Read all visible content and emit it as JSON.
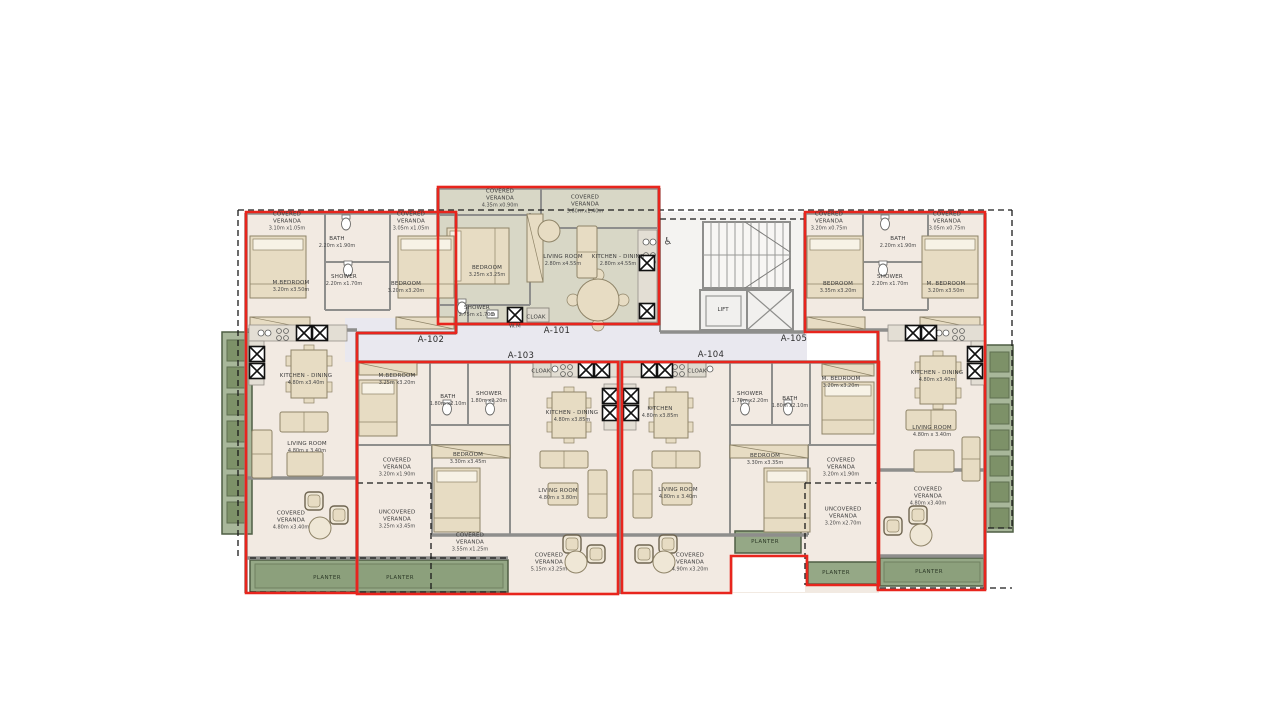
{
  "plan_title": "Typical floor plan — apartments A-101 to A-105",
  "colors": {
    "unit_outline_red": "#E8251D",
    "floor_beige": "#F2EAE2",
    "floor_a101": "#D8D7C6",
    "corridor": "#E9E8EF",
    "core_floor": "#F4F3F1",
    "wall_gray": "#8E8E8C",
    "planter_green": "#95A886",
    "planter_dark": "#7D9168",
    "planter_border": "#4F5E44",
    "furniture_tan": "#E7DCC3",
    "furniture_line": "#8F8468",
    "dash_black": "#1A1A1A"
  },
  "units": [
    {
      "id": "A-101",
      "x": 557,
      "y": 331
    },
    {
      "id": "A-102",
      "x": 431,
      "y": 340
    },
    {
      "id": "A-103",
      "x": 521,
      "y": 356
    },
    {
      "id": "A-104",
      "x": 711,
      "y": 355
    },
    {
      "id": "A-105",
      "x": 794,
      "y": 339
    }
  ],
  "rooms": [
    {
      "unit": "A-101",
      "name": "COVERED\nVERANDA",
      "dims": "4.35m x0.90m",
      "x": 500,
      "y": 199
    },
    {
      "unit": "A-101",
      "name": "COVERED\nVERANDA",
      "dims": "5.60m x1.40m",
      "x": 585,
      "y": 205
    },
    {
      "unit": "A-101",
      "name": "BEDROOM",
      "dims": "3.25m x3.25m",
      "x": 487,
      "y": 272
    },
    {
      "unit": "A-101",
      "name": "LIVING ROOM",
      "dims": "2.80m x4.55m",
      "x": 563,
      "y": 261
    },
    {
      "unit": "A-101",
      "name": "KITCHEN - DINING",
      "dims": "2.80m x4.55m",
      "x": 618,
      "y": 261
    },
    {
      "unit": "A-101",
      "name": "SHOWER",
      "dims": "2.75m x1.70m",
      "x": 477,
      "y": 312
    },
    {
      "unit": "A-101",
      "name": "W.M",
      "dims": "",
      "x": 515,
      "y": 327
    },
    {
      "unit": "A-101",
      "name": "CLOAK",
      "dims": "",
      "x": 536,
      "y": 318
    },
    {
      "unit": "A-102",
      "name": "COVERED\nVERANDA",
      "dims": "3.10m x1.05m",
      "x": 287,
      "y": 222
    },
    {
      "unit": "A-102",
      "name": "COVERED\nVERANDA",
      "dims": "3.05m x1.05m",
      "x": 411,
      "y": 222
    },
    {
      "unit": "A-102",
      "name": "BATH",
      "dims": "2.20m x1.90m",
      "x": 337,
      "y": 243
    },
    {
      "unit": "A-102",
      "name": "SHOWER",
      "dims": "2.20m x1.70m",
      "x": 344,
      "y": 281
    },
    {
      "unit": "A-102",
      "name": "M.BEDROOM",
      "dims": "3.20m x3.50m",
      "x": 291,
      "y": 287
    },
    {
      "unit": "A-102",
      "name": "BEDROOM",
      "dims": "3.20m x3.20m",
      "x": 406,
      "y": 288
    },
    {
      "unit": "A-102",
      "name": "KITCHEN - DINING",
      "dims": "4.80m x3.40m",
      "x": 306,
      "y": 380
    },
    {
      "unit": "A-102",
      "name": "LIVING ROOM",
      "dims": "4.80m x 3.40m",
      "x": 307,
      "y": 448
    },
    {
      "unit": "A-102",
      "name": "COVERED\nVERANDA",
      "dims": "4.80m x3.40m",
      "x": 291,
      "y": 521
    },
    {
      "unit": "A-103",
      "name": "M.BEDROOM",
      "dims": "3.25m x3.20m",
      "x": 397,
      "y": 380
    },
    {
      "unit": "A-103",
      "name": "BATH",
      "dims": "1.80m x2.10m",
      "x": 448,
      "y": 401
    },
    {
      "unit": "A-103",
      "name": "SHOWER",
      "dims": "1.80m x2.20m",
      "x": 489,
      "y": 398
    },
    {
      "unit": "A-103",
      "name": "CLOAK",
      "dims": "",
      "x": 541,
      "y": 372
    },
    {
      "unit": "A-103",
      "name": "KITCHEN - DINING",
      "dims": "4.80m x3.85m",
      "x": 572,
      "y": 417
    },
    {
      "unit": "A-103",
      "name": "BEDROOM",
      "dims": "3.30m x3.45m",
      "x": 468,
      "y": 459
    },
    {
      "unit": "A-103",
      "name": "COVERED\nVERANDA",
      "dims": "3.20m x1.90m",
      "x": 397,
      "y": 468
    },
    {
      "unit": "A-103",
      "name": "UNCOVERED\nVERANDA",
      "dims": "3.25m x3.45m",
      "x": 397,
      "y": 520
    },
    {
      "unit": "A-103",
      "name": "COVERED\nVERANDA",
      "dims": "3.55m x1.25m",
      "x": 470,
      "y": 543
    },
    {
      "unit": "A-103",
      "name": "LIVING ROOM",
      "dims": "4.80m x 3.80m",
      "x": 558,
      "y": 495
    },
    {
      "unit": "A-103",
      "name": "COVERED\nVERANDA",
      "dims": "5.15m x3.25m",
      "x": 549,
      "y": 563
    },
    {
      "unit": "A-104",
      "name": "CLOAK",
      "dims": "",
      "x": 697,
      "y": 372
    },
    {
      "unit": "A-104",
      "name": "KITCHEN",
      "dims": "4.80m x3.85m",
      "x": 660,
      "y": 413
    },
    {
      "unit": "A-104",
      "name": "SHOWER",
      "dims": "1.70m x2.20m",
      "x": 750,
      "y": 398
    },
    {
      "unit": "A-104",
      "name": "BATH",
      "dims": "1.80m x2.10m",
      "x": 790,
      "y": 403
    },
    {
      "unit": "A-104",
      "name": "M. BEDROOM",
      "dims": "3.20m x3.20m",
      "x": 841,
      "y": 383
    },
    {
      "unit": "A-104",
      "name": "BEDROOM",
      "dims": "3.30m x3.35m",
      "x": 765,
      "y": 460
    },
    {
      "unit": "A-104",
      "name": "COVERED\nVERANDA",
      "dims": "3.20m x1.90m",
      "x": 841,
      "y": 468
    },
    {
      "unit": "A-104",
      "name": "LIVING ROOM",
      "dims": "4.80m x 3.40m",
      "x": 678,
      "y": 494
    },
    {
      "unit": "A-104",
      "name": "UNCOVERED\nVERANDA",
      "dims": "3.20m x2.70m",
      "x": 843,
      "y": 517
    },
    {
      "unit": "A-104",
      "name": "COVERED\nVERANDA",
      "dims": "4.90m x3.20m",
      "x": 690,
      "y": 563
    },
    {
      "unit": "A-105",
      "name": "COVERED\nVERANDA",
      "dims": "3.20m x0.75m",
      "x": 829,
      "y": 222
    },
    {
      "unit": "A-105",
      "name": "COVERED\nVERANDA",
      "dims": "3.05m x0.75m",
      "x": 947,
      "y": 222
    },
    {
      "unit": "A-105",
      "name": "BATH",
      "dims": "2.20m x1.90m",
      "x": 898,
      "y": 243
    },
    {
      "unit": "A-105",
      "name": "SHOWER",
      "dims": "2.20m x1.70m",
      "x": 890,
      "y": 281
    },
    {
      "unit": "A-105",
      "name": "BEDROOM",
      "dims": "3.35m x3.20m",
      "x": 838,
      "y": 288
    },
    {
      "unit": "A-105",
      "name": "M. BEDROOM",
      "dims": "3.20m x3.50m",
      "x": 946,
      "y": 288
    },
    {
      "unit": "A-105",
      "name": "KITCHEN - DINING",
      "dims": "4.80m x3.40m",
      "x": 937,
      "y": 377
    },
    {
      "unit": "A-105",
      "name": "LIVING ROOM",
      "dims": "4.80m x 3.40m",
      "x": 932,
      "y": 432
    },
    {
      "unit": "A-105",
      "name": "COVERED\nVERANDA",
      "dims": "4.80m x3.40m",
      "x": 928,
      "y": 497
    }
  ],
  "planter_label": "PLANTER",
  "planters": [
    {
      "x": 327,
      "y": 578
    },
    {
      "x": 400,
      "y": 578
    },
    {
      "x": 765,
      "y": 542
    },
    {
      "x": 836,
      "y": 573
    },
    {
      "x": 929,
      "y": 572
    }
  ],
  "core": {
    "lift_label": "LIFT",
    "lift_x": 723,
    "lift_y": 310,
    "accessible_icon": "♿",
    "icon_x": 668,
    "icon_y": 242
  },
  "furniture": [
    {
      "type": "bed",
      "x": 447,
      "y": 228,
      "w": 62,
      "h": 56
    },
    {
      "type": "bed",
      "x": 250,
      "y": 236,
      "w": 56,
      "h": 62
    },
    {
      "type": "bed",
      "x": 398,
      "y": 236,
      "w": 56,
      "h": 62
    },
    {
      "type": "bed",
      "x": 359,
      "y": 380,
      "w": 38,
      "h": 56
    },
    {
      "type": "bed",
      "x": 434,
      "y": 468,
      "w": 46,
      "h": 64
    },
    {
      "type": "bed",
      "x": 764,
      "y": 468,
      "w": 46,
      "h": 64
    },
    {
      "type": "bed",
      "x": 822,
      "y": 382,
      "w": 52,
      "h": 52
    },
    {
      "type": "bed",
      "x": 807,
      "y": 236,
      "w": 56,
      "h": 62
    },
    {
      "type": "bed",
      "x": 922,
      "y": 236,
      "w": 56,
      "h": 62
    },
    {
      "type": "wardrobe",
      "x": 527,
      "y": 214,
      "w": 16,
      "h": 68
    },
    {
      "type": "wardrobe",
      "x": 250,
      "y": 317,
      "w": 60,
      "h": 12
    },
    {
      "type": "wardrobe",
      "x": 396,
      "y": 317,
      "w": 58,
      "h": 12
    },
    {
      "type": "wardrobe",
      "x": 807,
      "y": 317,
      "w": 58,
      "h": 12
    },
    {
      "type": "wardrobe",
      "x": 920,
      "y": 317,
      "w": 60,
      "h": 12
    },
    {
      "type": "wardrobe",
      "x": 432,
      "y": 445,
      "w": 78,
      "h": 13
    },
    {
      "type": "wardrobe",
      "x": 730,
      "y": 445,
      "w": 78,
      "h": 13
    },
    {
      "type": "wardrobe",
      "x": 359,
      "y": 363,
      "w": 58,
      "h": 12
    },
    {
      "type": "wardrobe",
      "x": 822,
      "y": 364,
      "w": 52,
      "h": 12
    },
    {
      "type": "dining",
      "x": 291,
      "y": 350,
      "w": 36,
      "h": 48
    },
    {
      "type": "dining",
      "x": 552,
      "y": 392,
      "w": 34,
      "h": 46
    },
    {
      "type": "dining",
      "x": 654,
      "y": 392,
      "w": 34,
      "h": 46
    },
    {
      "type": "dining",
      "x": 920,
      "y": 356,
      "w": 36,
      "h": 48
    },
    {
      "type": "round-dining",
      "x": 598,
      "y": 300,
      "w": 21
    },
    {
      "type": "sofa",
      "x": 280,
      "y": 412,
      "w": 48,
      "h": 20
    },
    {
      "type": "sofa",
      "x": 252,
      "y": 430,
      "w": 20,
      "h": 48
    },
    {
      "type": "sofa",
      "x": 540,
      "y": 451,
      "w": 48,
      "h": 17
    },
    {
      "type": "sofa",
      "x": 588,
      "y": 470,
      "w": 19,
      "h": 48
    },
    {
      "type": "sofa",
      "x": 652,
      "y": 451,
      "w": 48,
      "h": 17
    },
    {
      "type": "sofa",
      "x": 633,
      "y": 470,
      "w": 19,
      "h": 48
    },
    {
      "type": "sofa",
      "x": 906,
      "y": 410,
      "w": 50,
      "h": 20
    },
    {
      "type": "sofa",
      "x": 962,
      "y": 437,
      "w": 18,
      "h": 44
    },
    {
      "type": "sofa",
      "x": 577,
      "y": 226,
      "w": 20,
      "h": 52
    },
    {
      "type": "coffee",
      "x": 287,
      "y": 452,
      "w": 36,
      "h": 24
    },
    {
      "type": "coffee",
      "x": 548,
      "y": 483,
      "w": 30,
      "h": 22
    },
    {
      "type": "coffee",
      "x": 662,
      "y": 483,
      "w": 30,
      "h": 22
    },
    {
      "type": "coffee",
      "x": 914,
      "y": 450,
      "w": 40,
      "h": 22
    },
    {
      "type": "chair-round",
      "x": 549,
      "y": 231,
      "w": 11
    },
    {
      "type": "vchair",
      "x": 305,
      "y": 492,
      "w": 18
    },
    {
      "type": "vchair",
      "x": 330,
      "y": 506,
      "w": 18
    },
    {
      "type": "round-table",
      "x": 320,
      "y": 528,
      "w": 11
    },
    {
      "type": "vchair",
      "x": 563,
      "y": 535,
      "w": 18
    },
    {
      "type": "vchair",
      "x": 587,
      "y": 545,
      "w": 18
    },
    {
      "type": "round-table",
      "x": 576,
      "y": 562,
      "w": 11
    },
    {
      "type": "vchair",
      "x": 659,
      "y": 535,
      "w": 18
    },
    {
      "type": "vchair",
      "x": 635,
      "y": 545,
      "w": 18
    },
    {
      "type": "round-table",
      "x": 664,
      "y": 562,
      "w": 11
    },
    {
      "type": "vchair",
      "x": 909,
      "y": 506,
      "w": 18
    },
    {
      "type": "vchair",
      "x": 884,
      "y": 517,
      "w": 18
    },
    {
      "type": "round-table",
      "x": 921,
      "y": 535,
      "w": 11
    },
    {
      "type": "counter",
      "x": 638,
      "y": 230,
      "w": 19,
      "h": 92
    },
    {
      "type": "counter",
      "x": 249,
      "y": 325,
      "w": 98,
      "h": 16
    },
    {
      "type": "counter",
      "x": 249,
      "y": 341,
      "w": 15,
      "h": 44
    },
    {
      "type": "counter",
      "x": 539,
      "y": 362,
      "w": 80,
      "h": 15
    },
    {
      "type": "counter",
      "x": 604,
      "y": 384,
      "w": 14,
      "h": 46
    },
    {
      "type": "counter",
      "x": 622,
      "y": 362,
      "w": 80,
      "h": 15
    },
    {
      "type": "counter",
      "x": 622,
      "y": 384,
      "w": 14,
      "h": 46
    },
    {
      "type": "counter",
      "x": 888,
      "y": 325,
      "w": 98,
      "h": 16
    },
    {
      "type": "counter",
      "x": 971,
      "y": 341,
      "w": 15,
      "h": 44
    },
    {
      "type": "hob",
      "x": 643,
      "y": 252,
      "w": 12
    },
    {
      "type": "hob",
      "x": 276,
      "y": 328,
      "w": 12
    },
    {
      "type": "hob",
      "x": 560,
      "y": 364,
      "w": 12
    },
    {
      "type": "hob",
      "x": 672,
      "y": 364,
      "w": 12
    },
    {
      "type": "hob",
      "x": 952,
      "y": 328,
      "w": 12
    },
    {
      "type": "sink",
      "x": 643,
      "y": 238,
      "w": 10
    },
    {
      "type": "sink",
      "x": 258,
      "y": 329,
      "w": 10
    },
    {
      "type": "sink",
      "x": 545,
      "y": 365,
      "w": 10
    },
    {
      "type": "sink",
      "x": 700,
      "y": 365,
      "w": 10
    },
    {
      "type": "sink",
      "x": 936,
      "y": 329,
      "w": 10
    },
    {
      "type": "wc",
      "x": 346,
      "y": 222,
      "w": 9
    },
    {
      "type": "wc",
      "x": 348,
      "y": 268,
      "w": 9
    },
    {
      "type": "wc",
      "x": 447,
      "y": 407,
      "w": 9
    },
    {
      "type": "wc",
      "x": 490,
      "y": 407,
      "w": 9
    },
    {
      "type": "wc",
      "x": 745,
      "y": 407,
      "w": 9
    },
    {
      "type": "wc",
      "x": 788,
      "y": 407,
      "w": 9
    },
    {
      "type": "wc",
      "x": 885,
      "y": 222,
      "w": 9
    },
    {
      "type": "wc",
      "x": 883,
      "y": 268,
      "w": 9
    },
    {
      "type": "wc",
      "x": 462,
      "y": 306,
      "w": 9
    },
    {
      "type": "basin",
      "x": 487,
      "y": 310,
      "w": 11,
      "h": 8
    },
    {
      "type": "cloakbox",
      "x": 527,
      "y": 308,
      "w": 22,
      "h": 14
    },
    {
      "type": "cloakbox",
      "x": 533,
      "y": 363,
      "w": 18,
      "h": 14
    },
    {
      "type": "cloakbox",
      "x": 688,
      "y": 363,
      "w": 18,
      "h": 14
    }
  ],
  "xboxes": [
    [
      304,
      333
    ],
    [
      320,
      333
    ],
    [
      257,
      354
    ],
    [
      257,
      371
    ],
    [
      515,
      315
    ],
    [
      647,
      263
    ],
    [
      647,
      311
    ],
    [
      586,
      370
    ],
    [
      602,
      370
    ],
    [
      610,
      396
    ],
    [
      610,
      413
    ],
    [
      649,
      370
    ],
    [
      665,
      370
    ],
    [
      631,
      396
    ],
    [
      631,
      413
    ],
    [
      913,
      333
    ],
    [
      929,
      333
    ],
    [
      975,
      354
    ],
    [
      975,
      371
    ]
  ]
}
